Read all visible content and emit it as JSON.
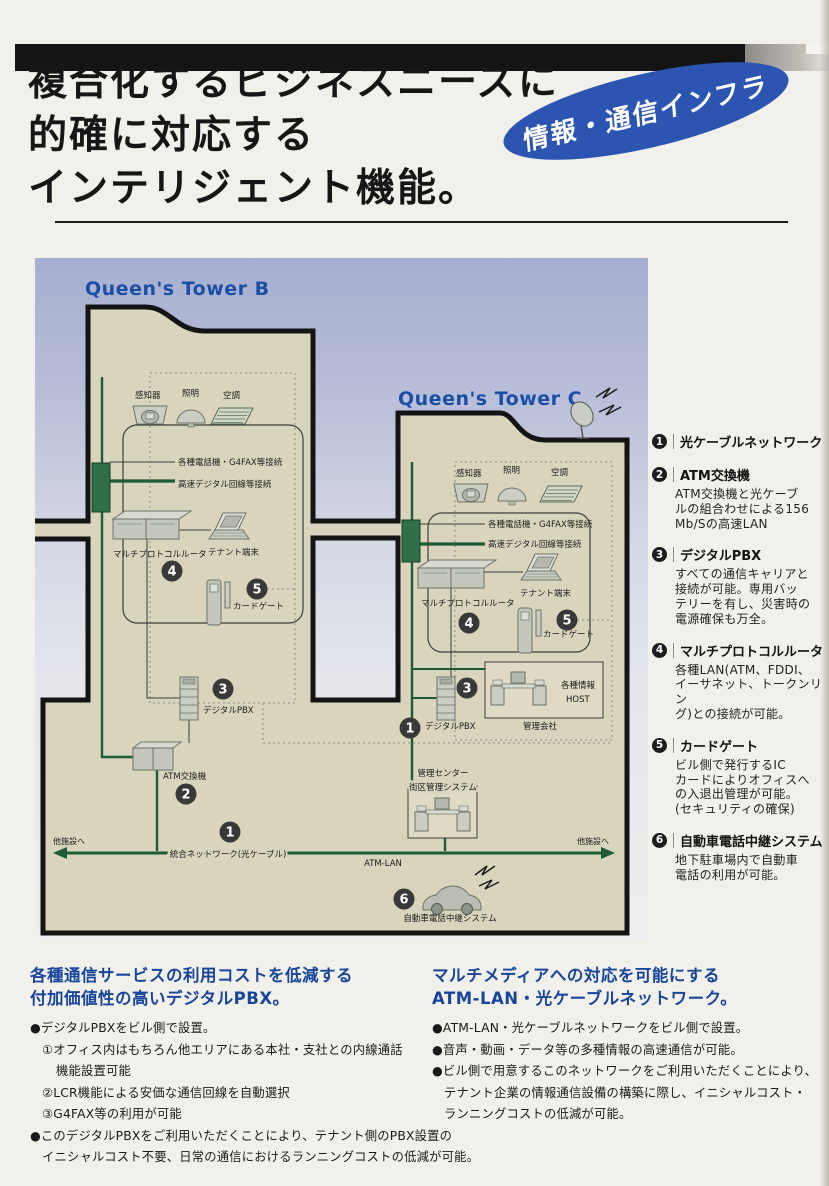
{
  "header": {
    "title": "複合化するビジネスニーズに\n的確に対応する\nインテリジェント機能。",
    "badge": "情報・通信インフラ"
  },
  "diagram": {
    "tower_b": "Queen's Tower B",
    "tower_c": "Queen's Tower C",
    "nums": [
      "1",
      "2",
      "3",
      "4",
      "5",
      "6"
    ],
    "labels": {
      "sensor": "感知器",
      "lighting": "照明",
      "aircon": "空調",
      "phones": "各種電話機・G4FAX等接続",
      "digital_line": "高速デジタル回線等接続",
      "router": "マルチプロトコルルータ",
      "tenant_terminal": "テナント端末",
      "card_gate": "カードゲート",
      "digital_pbx": "デジタルPBX",
      "atm_switch": "ATM交換機",
      "info_host": "各種情報",
      "host": "HOST",
      "mgmt_company": "管理会社",
      "mgmt_center": "管理センター",
      "district_system": "街区管理システム",
      "backbone": "統合ネットワーク(光ケーブル)",
      "atm_lan": "ATM-LAN",
      "to_other_left": "他施設へ",
      "to_other_right": "他施設へ",
      "car_phone": "自動車電話中継システム"
    }
  },
  "sidebar": {
    "items": [
      {
        "num": "1",
        "title": "光ケーブルネットワーク",
        "desc": ""
      },
      {
        "num": "2",
        "title": "ATM交換機",
        "desc": "ATM交換機と光ケーブ\nルの組合わせによる156\nMb/Sの高速LAN"
      },
      {
        "num": "3",
        "title": "デジタルPBX",
        "desc": "すべての通信キャリアと\n接続が可能。専用バッ\nテリーを有し、災害時の\n電源確保も万全。"
      },
      {
        "num": "4",
        "title": "マルチプロトコルルータ",
        "desc": "各種LAN(ATM、FDDI、\nイーサネット、トークンリン\nグ)との接続が可能。"
      },
      {
        "num": "5",
        "title": "カードゲート",
        "desc": "ビル側で発行するIC\nカードによりオフィスへ\nの入退出管理が可能。\n(セキュリティの確保)"
      },
      {
        "num": "6",
        "title": "自動車電話中継システム",
        "desc": "地下駐車場内で自動車\n電話の利用が可能。"
      }
    ]
  },
  "sections": {
    "pbx": {
      "heading": "各種通信サービスの利用コストを低減する\n付加価値性の高いデジタルPBX。",
      "lines": [
        "●デジタルPBXをビル側で設置。",
        "①オフィス内はもちろん他エリアにある本社・支社との内線通話",
        "機能設置可能",
        "②LCR機能による安価な通信回線を自動選択",
        "③G4FAX等の利用が可能",
        "●このデジタルPBXをご利用いただくことにより、テナント側のPBX設置の",
        "イニシャルコスト不要、日常の通信におけるランニングコストの低減が可能。"
      ]
    },
    "atm": {
      "heading": "マルチメディアへの対応を可能にする\nATM-LAN・光ケーブルネットワーク。",
      "lines": [
        "●ATM-LAN・光ケーブルネットワークをビル側で設置。",
        "●音声・動画・データ等の多種情報の高速通信が可能。",
        "●ビル側で用意するこのネットワークをご利用いただくことにより、",
        "テナント企業の情報通信設備の構築に際し、イニシャルコスト・",
        "ランニングコストの低減が可能。"
      ]
    }
  }
}
